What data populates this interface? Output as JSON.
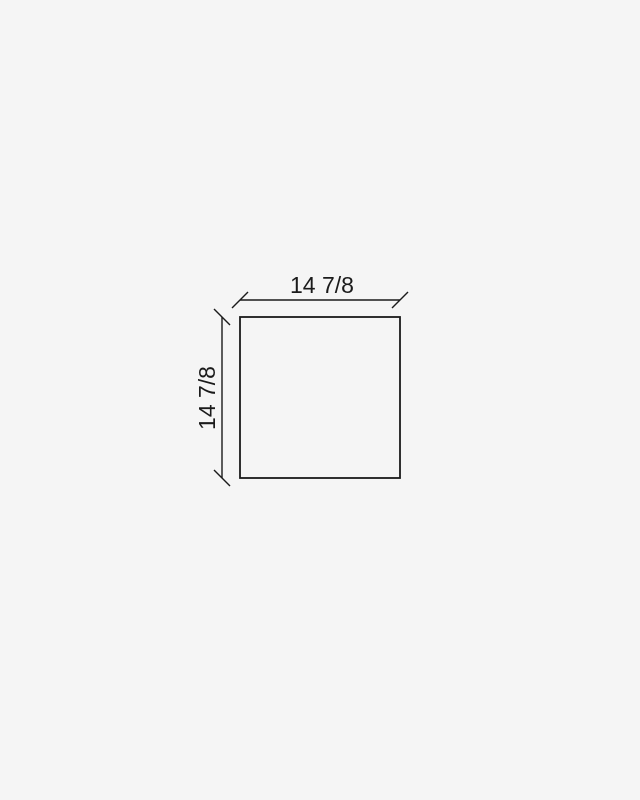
{
  "diagram": {
    "shape_outline": "rectangle",
    "dimensions": {
      "width": {
        "label": "14 7/8"
      },
      "height": {
        "label": "14 7/8"
      }
    },
    "colors": {
      "background": "#f5f5f5",
      "line": "#1b1b1b",
      "text": "#1a1a1a"
    }
  }
}
